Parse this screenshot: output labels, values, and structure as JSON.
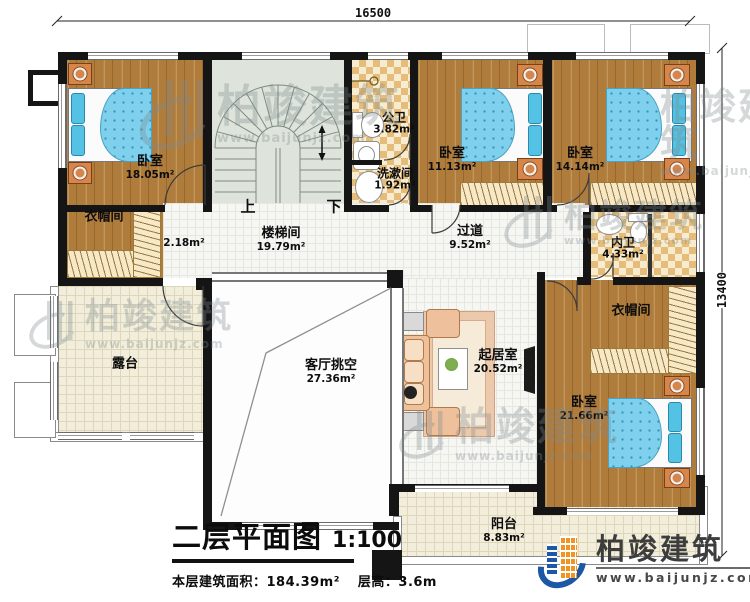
{
  "meta": {
    "plan_title": "二层平面图",
    "scale": "1:100",
    "floor_area_label": "本层建筑面积：184.39m²",
    "floor_height_label": "层高：3.6m"
  },
  "dimensions": {
    "top": "16500",
    "right": "13400"
  },
  "stairs": {
    "up": "上",
    "down": "下"
  },
  "rooms": {
    "bedroom1": {
      "name": "卧室",
      "area": "18.05m²"
    },
    "cloakroom1": {
      "name": "衣帽间",
      "area": "2.18m²"
    },
    "stairwell": {
      "name": "楼梯间",
      "area": "19.79m²"
    },
    "public_bath": {
      "name": "公卫",
      "area": "3.82m²"
    },
    "washroom": {
      "name": "洗漱间",
      "area": "1.92m²"
    },
    "bedroom2": {
      "name": "卧室",
      "area": "11.13m²"
    },
    "bedroom3": {
      "name": "卧室",
      "area": "14.14m²"
    },
    "corridor": {
      "name": "过道",
      "area": "9.52m²"
    },
    "inner_bath": {
      "name": "内卫",
      "area": "4.33m²"
    },
    "cloakroom2": {
      "name": "衣帽间"
    },
    "bedroom4": {
      "name": "卧室",
      "area": "21.66m²"
    },
    "terrace": {
      "name": "露台"
    },
    "living_void": {
      "name": "客厅挑空",
      "area": "27.36m²"
    },
    "sitting_room": {
      "name": "起居室",
      "area": "20.52m²"
    },
    "balcony": {
      "name": "阳台",
      "area": "8.83m²"
    }
  },
  "watermark": {
    "brand": "柏竣建筑",
    "url": "www.baijunjz.com"
  },
  "logo": {
    "brand": "柏竣建筑",
    "url": "www.baijunjz.com"
  },
  "colors": {
    "wall": "#151515",
    "wood_floor": "#b07c3c",
    "checker_tile": "#e5bc79",
    "bed_blue": "#7fd0ec",
    "stair": "#dee4db",
    "logo_blue": "#1c58a5",
    "logo_orange": "#f29422"
  }
}
